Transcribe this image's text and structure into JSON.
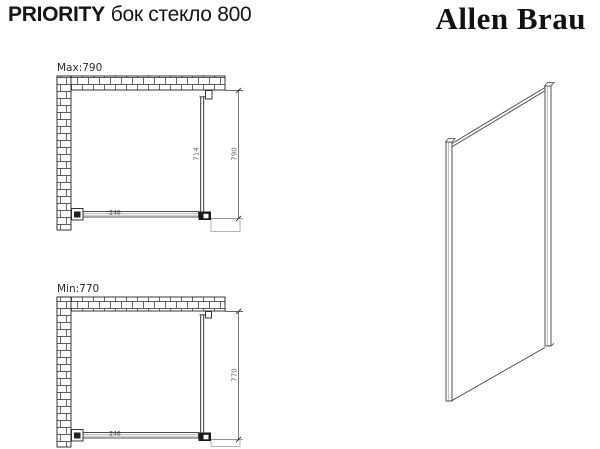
{
  "header": {
    "series": "PRIORITY",
    "model": "бок стекло 800",
    "brand": "Allen Brau"
  },
  "diagram_max": {
    "label": "Max:790",
    "dim_total": "790",
    "dim_glass": "714",
    "dim_bar": "246"
  },
  "diagram_min": {
    "label": "Min:770",
    "dim_total": "770",
    "dim_bar": "246"
  },
  "colors": {
    "ink": "#222222",
    "dim_line": "#555555",
    "shadow_gray": "#b3b3b3"
  }
}
